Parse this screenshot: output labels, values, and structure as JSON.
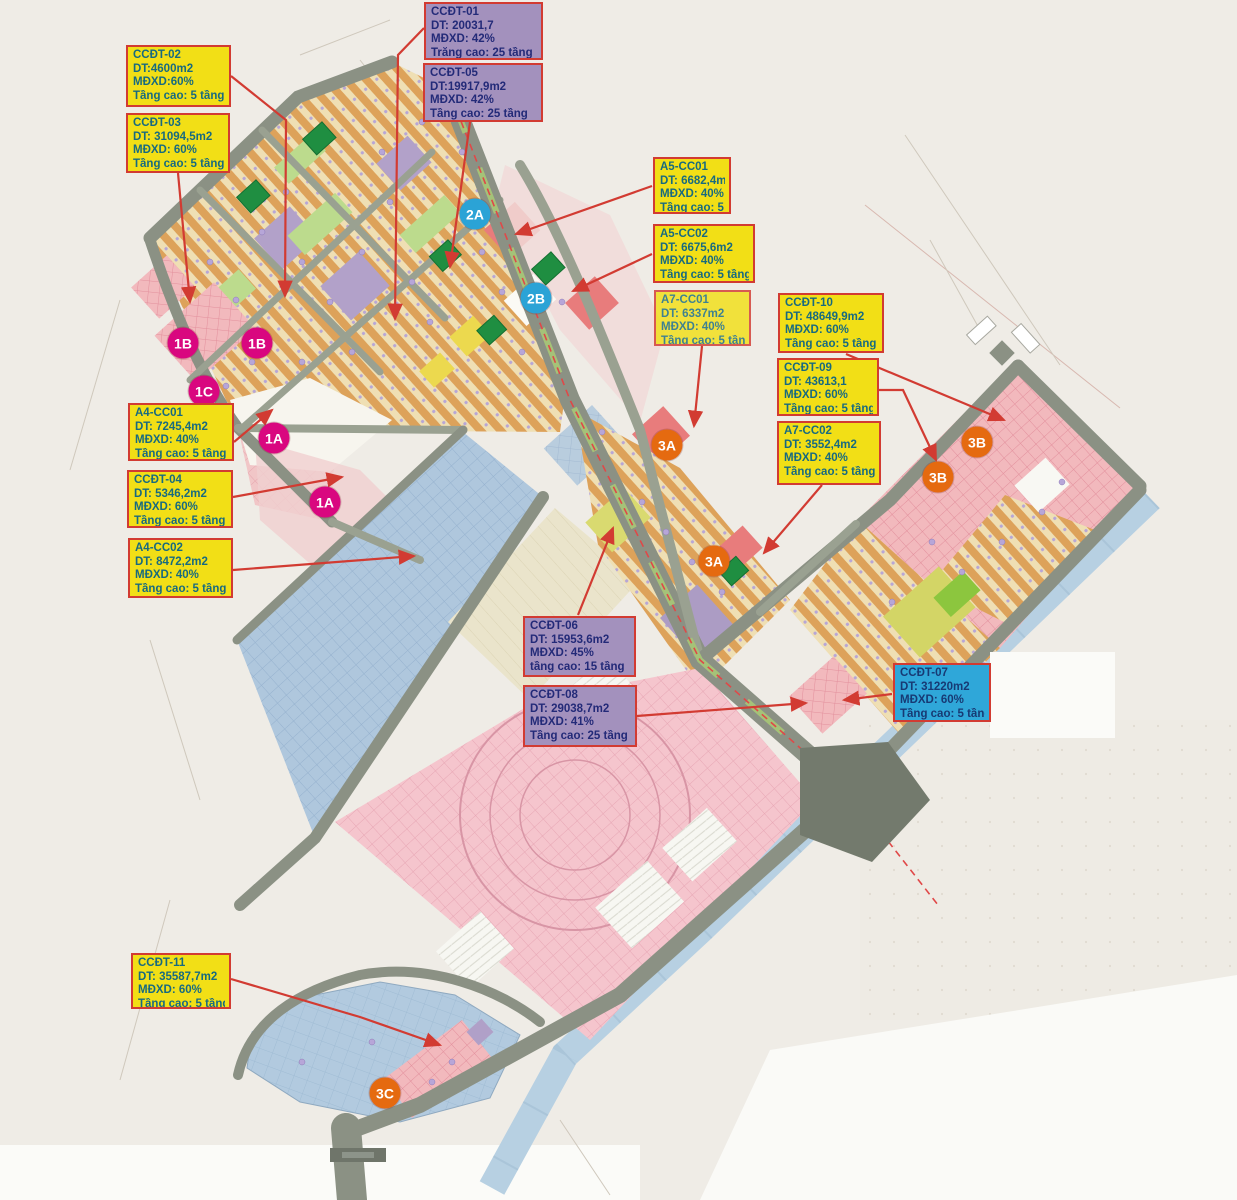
{
  "map": {
    "background_color": "#efece6",
    "callout_border_color": "#d23b32",
    "callout_backgrounds": {
      "yellow": "#f2df16",
      "purple": "#a391bd",
      "cyan": "#2fa7d9"
    },
    "labels": [
      {
        "id": "CCDT-02",
        "code": "CCĐT-02",
        "dt": "DT:4600m2",
        "mdxd": "MĐXD:60%",
        "tang": "Tầng cao: 5 tầng",
        "variant": "yellow",
        "x": 126,
        "y": 45,
        "w": 105,
        "h": 62
      },
      {
        "id": "CCDT-03",
        "code": "CCĐT-03",
        "dt": "DT: 31094,5m2",
        "mdxd": "MĐXD: 60%",
        "tang": "Tầng cao: 5 tầng",
        "variant": "yellow",
        "x": 126,
        "y": 113,
        "w": 104,
        "h": 60
      },
      {
        "id": "CCDT-01",
        "code": "CCĐT-01",
        "dt": "DT: 20031,7",
        "mdxd": "MĐXD: 42%",
        "tang": "Trằng cao: 25 tầng",
        "variant": "purple",
        "x": 424,
        "y": 2,
        "w": 119,
        "h": 58
      },
      {
        "id": "CCDT-05",
        "code": "CCĐT-05",
        "dt": "DT:19917,9m2",
        "mdxd": "MĐXD: 42%",
        "tang": "Tầng cao: 25 tầng",
        "variant": "purple",
        "x": 423,
        "y": 63,
        "w": 120,
        "h": 59
      },
      {
        "id": "A5-CC01",
        "code": "A5-CC01",
        "dt": "DT: 6682,4m2",
        "mdxd": "MĐXD: 40%",
        "tang": "Tầng cao: 5 tầng",
        "variant": "yellow",
        "x": 653,
        "y": 157,
        "w": 78,
        "h": 57
      },
      {
        "id": "A5-CC02",
        "code": "A5-CC02",
        "dt": "DT: 6675,6m2",
        "mdxd": "MĐXD: 40%",
        "tang": "Tầng cao: 5 tầng",
        "variant": "yellow",
        "x": 653,
        "y": 224,
        "w": 102,
        "h": 59
      },
      {
        "id": "A7-CC01",
        "code": "A7-CC01",
        "dt": "DT: 6337m2",
        "mdxd": "MĐXD: 40%",
        "tang": "Tầng cao: 5 tầng",
        "variant": "yellow faded",
        "x": 654,
        "y": 290,
        "w": 97,
        "h": 56
      },
      {
        "id": "CCDT-10",
        "code": "CCĐT-10",
        "dt": "DT: 48649,9m2",
        "mdxd": "MĐXD: 60%",
        "tang": "Tầng cao: 5 tầng",
        "variant": "yellow",
        "x": 778,
        "y": 293,
        "w": 106,
        "h": 60
      },
      {
        "id": "CCDT-09",
        "code": "CCĐT-09",
        "dt": "DT: 43613,1",
        "mdxd": "MĐXD: 60%",
        "tang": "Tầng cao: 5 tầng",
        "variant": "yellow",
        "x": 777,
        "y": 358,
        "w": 102,
        "h": 58
      },
      {
        "id": "A7-CC02",
        "code": "A7-CC02",
        "dt": "DT: 3552,4m2",
        "mdxd": "MĐXD: 40%",
        "tang": "Tầng cao: 5 tầng",
        "variant": "yellow",
        "x": 777,
        "y": 421,
        "w": 104,
        "h": 64
      },
      {
        "id": "A4-CC01",
        "code": "A4-CC01",
        "dt": "DT: 7245,4m2",
        "mdxd": "MĐXD: 40%",
        "tang": "Tầng cao: 5 tầng",
        "variant": "yellow",
        "x": 128,
        "y": 403,
        "w": 106,
        "h": 58
      },
      {
        "id": "CCDT-04",
        "code": "CCĐT-04",
        "dt": "DT: 5346,2m2",
        "mdxd": "MĐXD: 60%",
        "tang": "Tầng cao: 5 tầng",
        "variant": "yellow",
        "x": 127,
        "y": 470,
        "w": 106,
        "h": 58
      },
      {
        "id": "A4-CC02",
        "code": "A4-CC02",
        "dt": "DT: 8472,2m2",
        "mdxd": "MĐXD: 40%",
        "tang": "Tầng cao: 5 tầng",
        "variant": "yellow",
        "x": 128,
        "y": 538,
        "w": 105,
        "h": 60
      },
      {
        "id": "CCDT-06",
        "code": "CCĐT-06",
        "dt": "DT: 15953,6m2",
        "mdxd": "MĐXD: 45%",
        "tang": "tầng cao: 15 tầng",
        "variant": "purple",
        "x": 523,
        "y": 616,
        "w": 113,
        "h": 61
      },
      {
        "id": "CCDT-08",
        "code": "CCĐT-08",
        "dt": "DT: 29038,7m2",
        "mdxd": "MĐXD: 41%",
        "tang": "Tầng cao: 25 tầng",
        "variant": "purple",
        "x": 523,
        "y": 685,
        "w": 114,
        "h": 62
      },
      {
        "id": "CCDT-07",
        "code": "CCĐT-07",
        "dt": "DT: 31220m2",
        "mdxd": "MĐXD: 60%",
        "tang": "Tầng cao: 5 tầng",
        "variant": "cyan",
        "x": 893,
        "y": 663,
        "w": 98,
        "h": 59
      },
      {
        "id": "CCDT-11",
        "code": "CCĐT-11",
        "dt": "DT: 35587,7m2",
        "mdxd": "MĐXD: 60%",
        "tang": "Tầng cao: 5 tầng",
        "variant": "yellow",
        "x": 131,
        "y": 953,
        "w": 100,
        "h": 56
      }
    ],
    "badges": [
      {
        "text": "1B",
        "color": "#d9077f",
        "x": 183,
        "y": 343
      },
      {
        "text": "1B",
        "color": "#d9077f",
        "x": 257,
        "y": 343
      },
      {
        "text": "1C",
        "color": "#d9077f",
        "x": 204,
        "y": 391
      },
      {
        "text": "1A",
        "color": "#d9077f",
        "x": 274,
        "y": 438
      },
      {
        "text": "1A",
        "color": "#d9077f",
        "x": 325,
        "y": 502
      },
      {
        "text": "2A",
        "color": "#2ba3d6",
        "x": 475,
        "y": 214
      },
      {
        "text": "2B",
        "color": "#2ba3d6",
        "x": 536,
        "y": 298
      },
      {
        "text": "3A",
        "color": "#e56a10",
        "x": 667,
        "y": 445
      },
      {
        "text": "3A",
        "color": "#e56a10",
        "x": 714,
        "y": 561
      },
      {
        "text": "3B",
        "color": "#e56a10",
        "x": 977,
        "y": 442
      },
      {
        "text": "3B",
        "color": "#e56a10",
        "x": 938,
        "y": 477
      },
      {
        "text": "3C",
        "color": "#e56a10",
        "x": 385,
        "y": 1093
      }
    ]
  }
}
